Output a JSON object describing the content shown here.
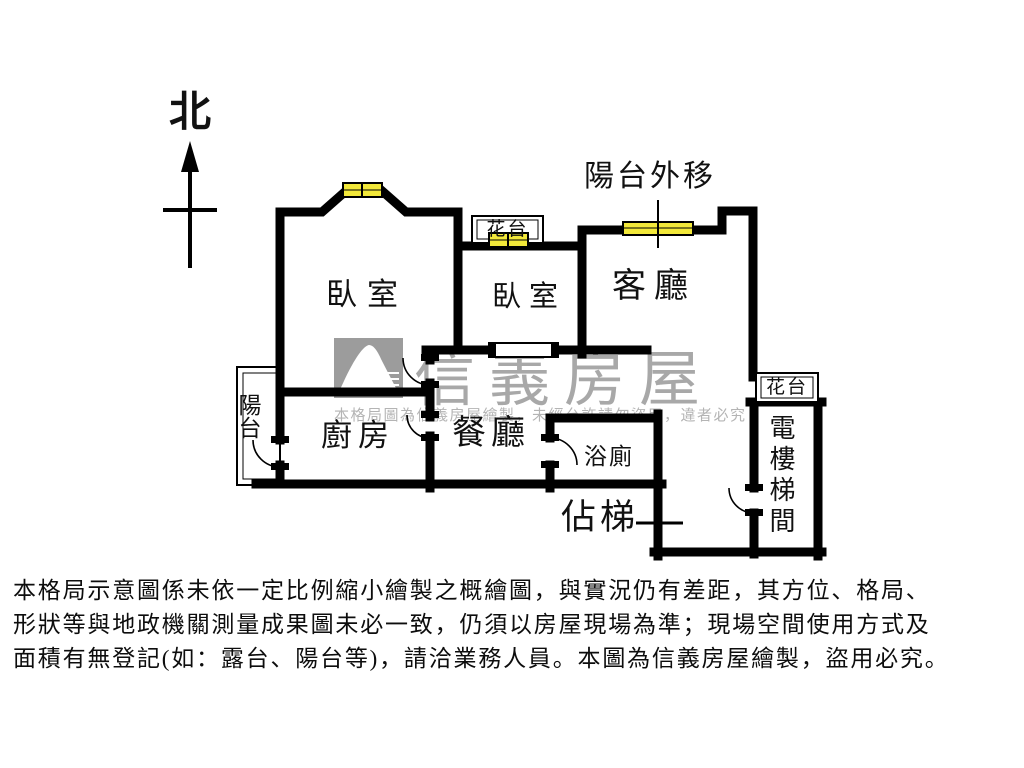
{
  "compass": {
    "north": "北"
  },
  "rooms": {
    "bedroom1": "臥室",
    "bedroom2": "臥室",
    "living_room": "客廳",
    "kitchen": "廚房",
    "dining_room": "餐廳",
    "bathroom": "浴廁",
    "balcony": "陽台",
    "balcony_moved_out": "陽台外移",
    "flower_bed_top": "花台",
    "flower_bed_right": "花台",
    "elevator_stairwell": "電樓梯間",
    "stair_occupied": "佔梯"
  },
  "watermark": {
    "brand": "信義房屋",
    "notice": "本格局圖為信義房屋繪製，未經允許請勿盜用，違者必究"
  },
  "disclaimer_lines": [
    "本格局示意圖係未依一定比例縮小繪製之概繪圖，與實況仍有差距，其方位、格局、",
    "形狀等與地政機關測量成果圖未必一致，仍須以房屋現場為準；現場空間使用方式及",
    "面積有無登記(如：露台、陽台等)，請洽業務人員。本圖為信義房屋繪製，盜用必究。"
  ],
  "colors": {
    "wall": "#000000",
    "window_fill": "#f2e83a",
    "watermark_gray": "#a8a8a8",
    "notice_gray": "#b4b4b4",
    "logo_gray": "#9c9c9c"
  }
}
